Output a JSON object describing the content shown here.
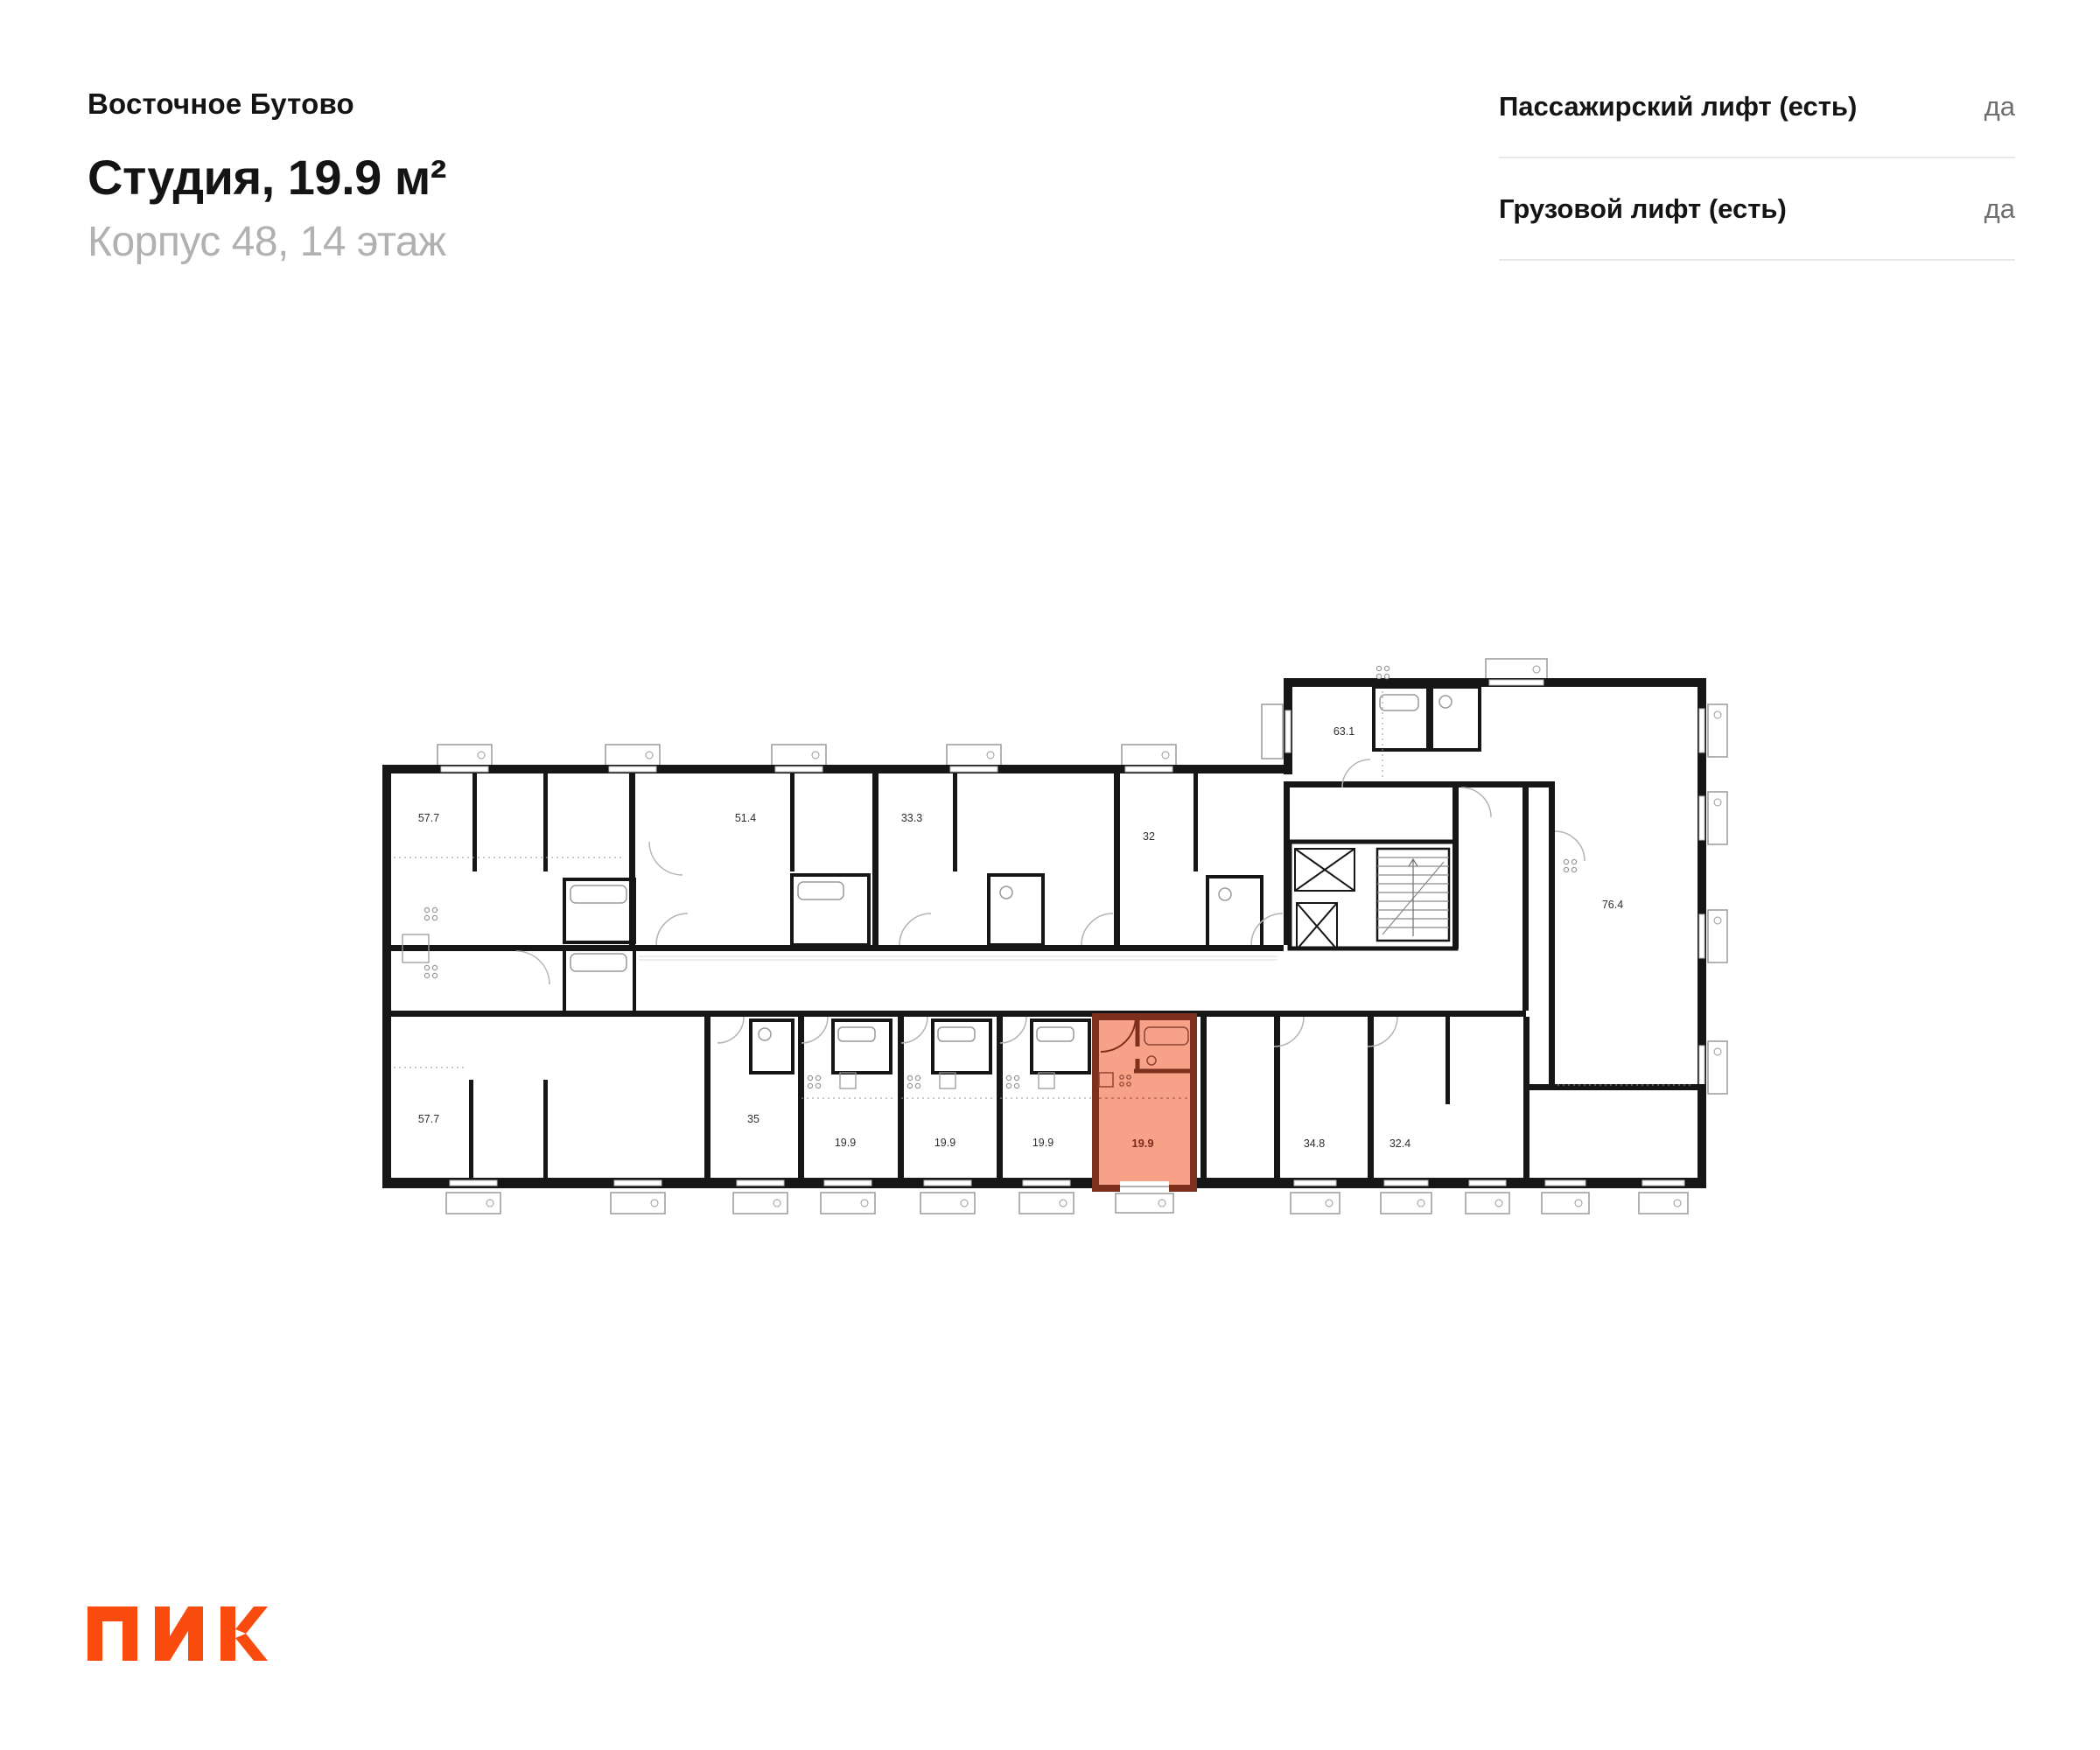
{
  "header": {
    "project": "Восточное Бутово",
    "title": "Студия, 19.9 м²",
    "subtitle": "Корпус 48, 14 этаж"
  },
  "lift_info": {
    "rows": [
      {
        "label": "Пассажирский лифт (есть)",
        "value": "да"
      },
      {
        "label": "Грузовой лифт (есть)",
        "value": "да"
      }
    ]
  },
  "floor_plan": {
    "highlighted_unit": {
      "area": "19.9",
      "type": "Студия"
    },
    "room_areas": {
      "top_row": [
        "57.7",
        "51.4",
        "33.3",
        "32"
      ],
      "right_wing": [
        "63.1",
        "76.4"
      ],
      "bottom_row": [
        "57.7",
        "35",
        "19.9",
        "19.9",
        "19.9",
        "19.9",
        "34.8",
        "32.4"
      ]
    }
  },
  "footer": {
    "logo_text": "ПИК"
  },
  "colors": {
    "accent_orange": "#F94B0E",
    "wall": "#161616",
    "highlight_fill": "#F8A189",
    "highlight_border": "#7E301F",
    "highlight_text": "#7C2D1B",
    "muted_text": "#6f6f6f",
    "subtitle_text": "#b1b1b1",
    "divider": "#e8e8e8"
  }
}
